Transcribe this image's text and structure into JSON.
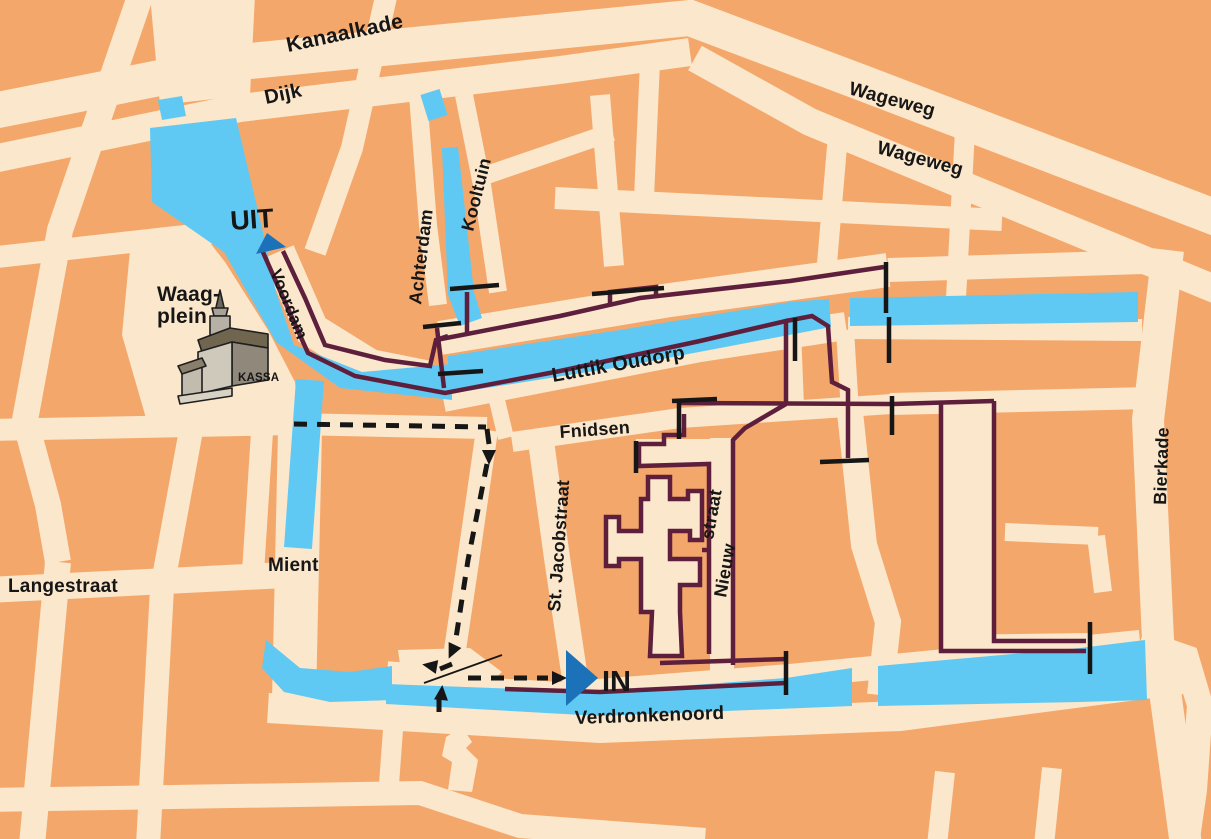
{
  "map_type": "tourist-canal-route-map",
  "colors": {
    "background_blocks": "#F4A76A",
    "streets": "#FBE7CB",
    "water": "#5FC9F3",
    "boat_route": "#5E1F3D",
    "bridge_marker": "#161616",
    "walking_route": "#161616",
    "entry_exit_marker": "#1B72B8",
    "label_ink": "#161616"
  },
  "labels": {
    "kanaalkade": "Kanaalkade",
    "dijk": "Dijk",
    "wageweg_upper": "Wageweg",
    "wageweg_lower": "Wageweg",
    "kooltuin": "Kooltuin",
    "achterdam": "Achterdam",
    "voordam": "Voordam",
    "luttik_oudorp": "Luttik Oudorp",
    "fnidsen": "Fnidsen",
    "st_jacobstraat": "St. Jacobstraat",
    "nieuwstraat_word1": "Nieuw",
    "nieuwstraat_word2": "straat",
    "mient": "Mient",
    "langestraat": "Langestraat",
    "verdronkenoord": "Verdronkenoord",
    "bierkade": "Bierkade"
  },
  "markers": {
    "exit_label": "UIT",
    "entrance_label": "IN",
    "kassa_label": "KASSA",
    "waagplein_line1": "Waag-",
    "waagplein_line2": "plein"
  },
  "icons": {
    "uit_arrow": "blue triangle pointing up the canal at the exit",
    "in_arrow": "blue triangle pointing east at the entrance",
    "waag_building": "3D drawing of the Waag building with tower",
    "bridge_bars": "black bars marking bridges / route ends",
    "dashed_route": "black dashed walking route with arrows"
  }
}
